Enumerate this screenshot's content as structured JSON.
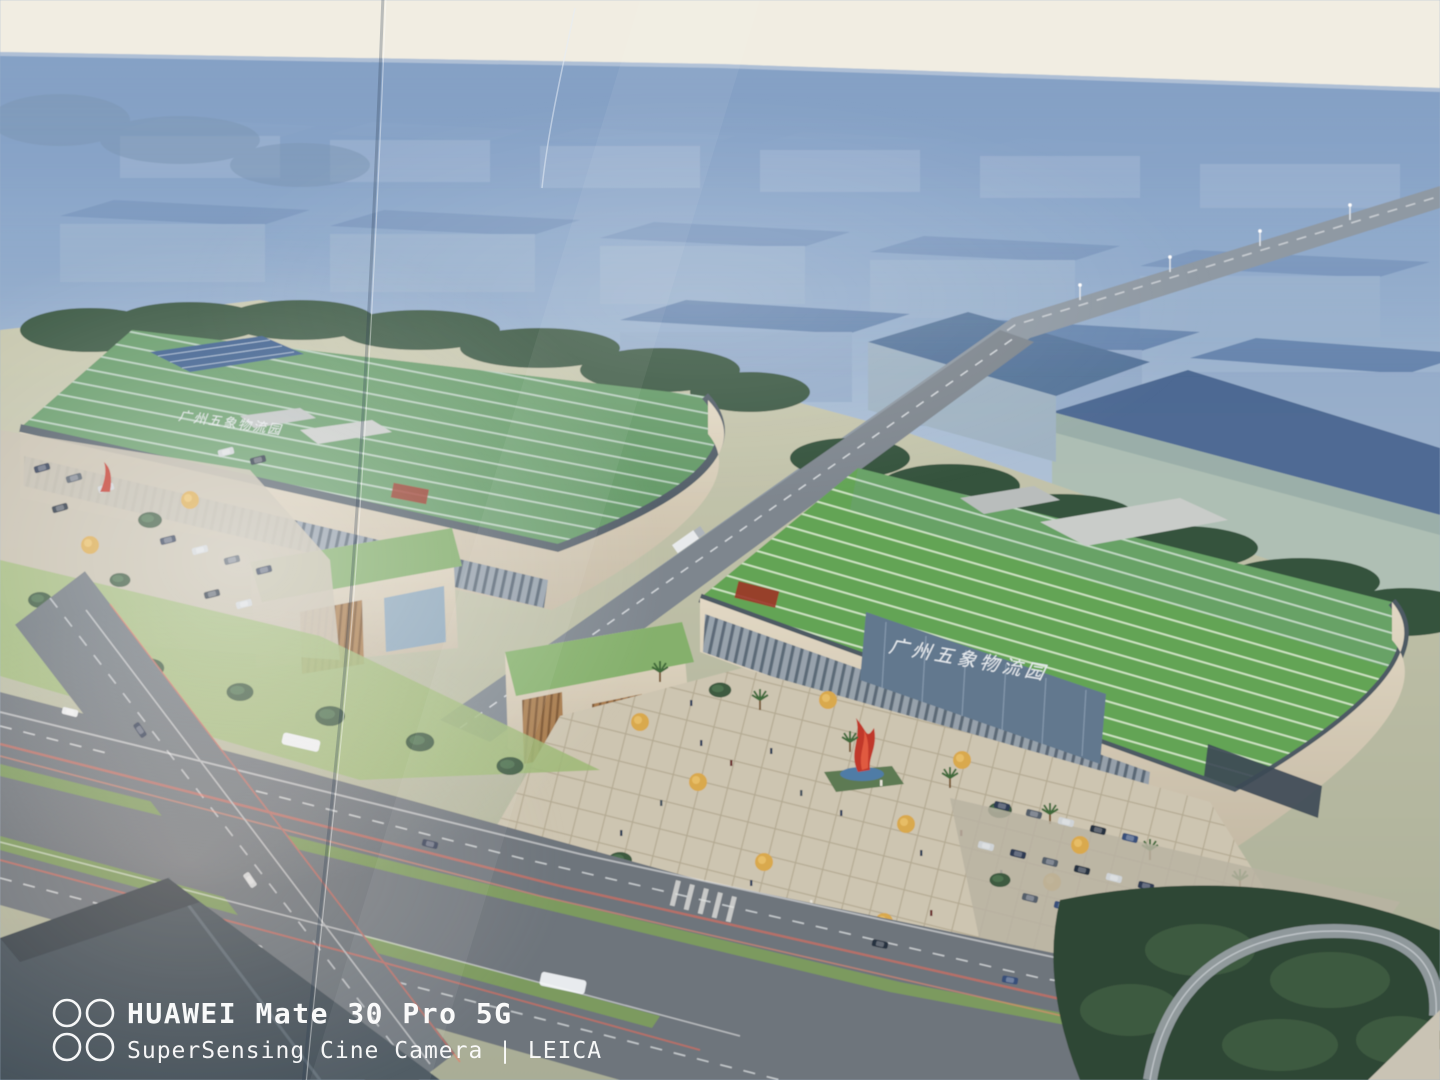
{
  "image_type": "photograph of a printed architectural rendering poster — aerial view of a logistics park",
  "watermark": {
    "device": "HUAWEI Mate 30 Pro 5G",
    "camera_line": "SuperSensing Cine Camera | LEICA",
    "icon": "quad-lens-icon",
    "text_color": "#ffffff"
  },
  "signage": {
    "right_building": "广州五象物流园",
    "left_building": "广州五象物流园"
  },
  "colors": {
    "poster_top_band": "#f1ede2",
    "horizon_blue": "#4a71a4",
    "haze_blue": "#aabfd6",
    "roof_green": "#5f9b50",
    "roof_stripe": "#cde3c2",
    "facade_beige": "#d8cdb9",
    "glass_blue": "#5d7289",
    "tree_dark_green": "#34513b",
    "tree_yellow": "#d9a94e",
    "road_gray": "#6e757b",
    "sculpture_red": "#c0392b",
    "plaza_paving": "#cdc5b1",
    "dark_roof": "#46525c"
  }
}
